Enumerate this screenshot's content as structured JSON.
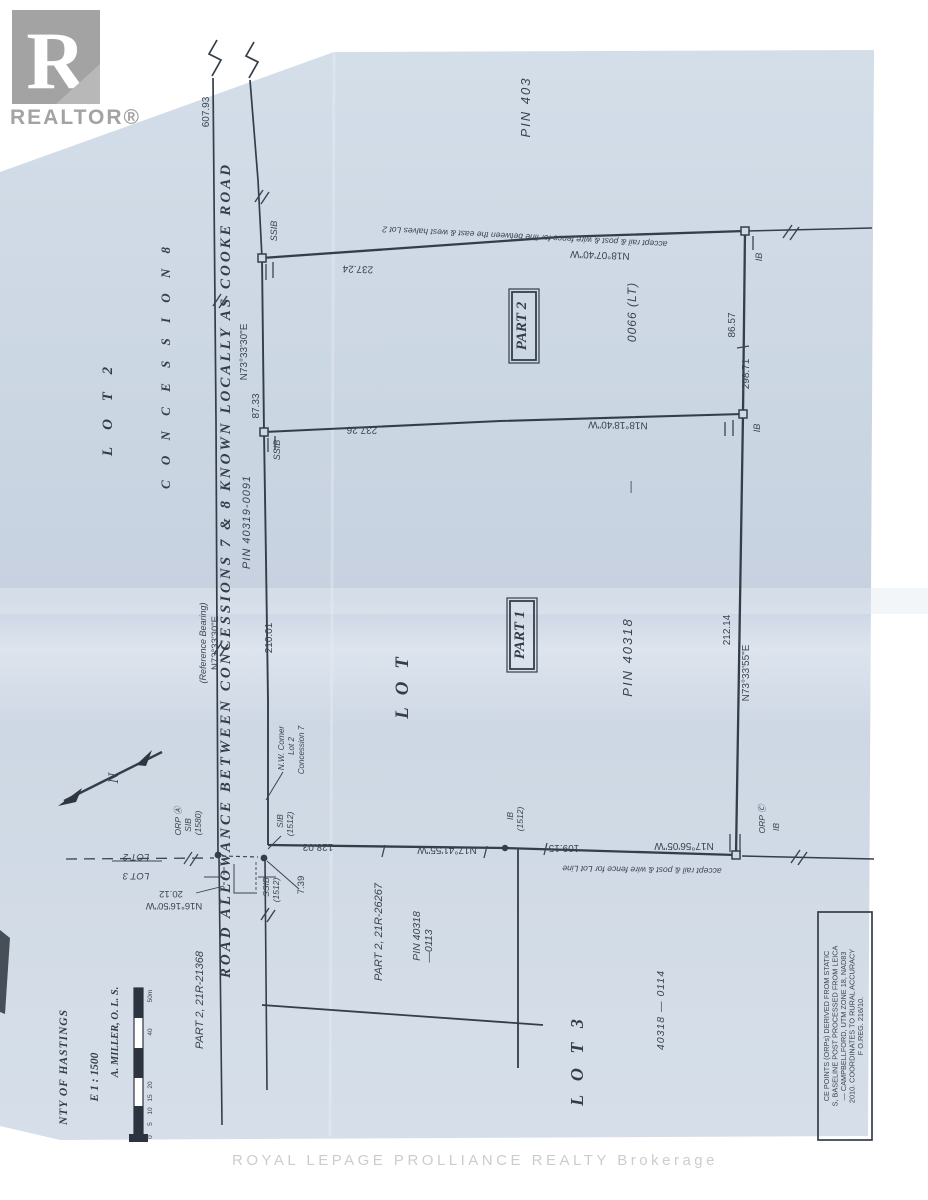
{
  "wm": {
    "realtor_r": "R",
    "realtor": "REALTOR®",
    "brokerage": "ROYAL LEPAGE PROLLIANCE REALTY  Brokerage"
  },
  "road": {
    "name": "ROAD   ALLOWANCE   BETWEEN   CONCESSIONS   7  &  8   KNOWN   LOCALLY   AS   COOKE   ROAD",
    "pin": "PIN 40319-0091",
    "d607": "607.93",
    "ref_note": "(Reference Bearing)",
    "ref_bearing": "N73°33'30\"E",
    "seg_bearing": "N73°33'30\"E",
    "seg_dist": "87.33",
    "d210": "210.01",
    "part_21368": "PART 2,  21R-21368"
  },
  "north": {
    "accept": "accept rail & post & wire fence for line between the east & west halves Lot 2",
    "dist": "237.24",
    "bearing": "N18°07'40\"W",
    "ssib": "SSIB",
    "ib": "IB"
  },
  "middle": {
    "dist": "237.26",
    "bearing": "N18°18'40\"W",
    "ssib": "SSIB",
    "ib": "IB"
  },
  "east": {
    "d8657": "86.57",
    "d29871": "298.71",
    "d21214": "212.14",
    "bearing": "N73°33'55\"E"
  },
  "south": {
    "d12803": "128.03",
    "b1741": "N17°41'55\"W",
    "d10915": "109.15",
    "b1756": "N17°56'05\"W",
    "accept": "accept rail & post & wire fence for Lot Line",
    "ib": "IB",
    "ib_no": "(1512)",
    "orp": "ORP Ⓒ",
    "orp_ib": "IB"
  },
  "west": {
    "orpa": "ORP Ⓐ",
    "orpa_sib": "SIB",
    "orpa_no": "(1580)",
    "sib": "SIB",
    "sib_no": "(1512)",
    "ssib": "SSIB",
    "ssib_no": "(1512)",
    "d739": "7.39",
    "d2012": "20.12",
    "b1616": "N16°16'50\"W",
    "lot2": "LOT  2",
    "lot3": "LOT  3",
    "nw1": "N.W. Corner",
    "nw2": "Lot 2",
    "nw3": "Concession 7"
  },
  "parcels": {
    "part2": "PART 2",
    "part1": "PART 1",
    "pin403": "PIN     403",
    "pin0066": "0066    (LT)",
    "dash": "—",
    "pin40318": "PIN      40318",
    "lot_big": "L  O  T",
    "lot2_col": "L  O  T          2",
    "conc_col": "C O N C E S S I O N          8",
    "lot3_big": "L  O  T      3",
    "part_26267": "PART 2,  21R-26267",
    "pin0113a": "PIN 40318",
    "pin0113b": "—0113",
    "pin0114": "40318    —    0114"
  },
  "title": {
    "county": "NTY   OF   HASTINGS",
    "scale": "E  1 : 1500",
    "surveyor": "A.  MILLER,   O. L. S.",
    "t0": "0",
    "t5": "5",
    "t10": "10",
    "t15": "15",
    "t20": "20",
    "t40": "40",
    "t50": "50m"
  },
  "notes": {
    "l1": "CE POINTS (ORPs) DERIVED FROM STATIC",
    "l2": "S, BASELINE POST PROCESSED FROM LEICA",
    "l3": "— CAMPBELLFORD, UTM ZONE 18, NAD83",
    "l4": "2010. COORDINATES TO RURAL ACCURACY",
    "l5": "F O.REG. 216/10."
  },
  "compass": {
    "n": "N"
  }
}
